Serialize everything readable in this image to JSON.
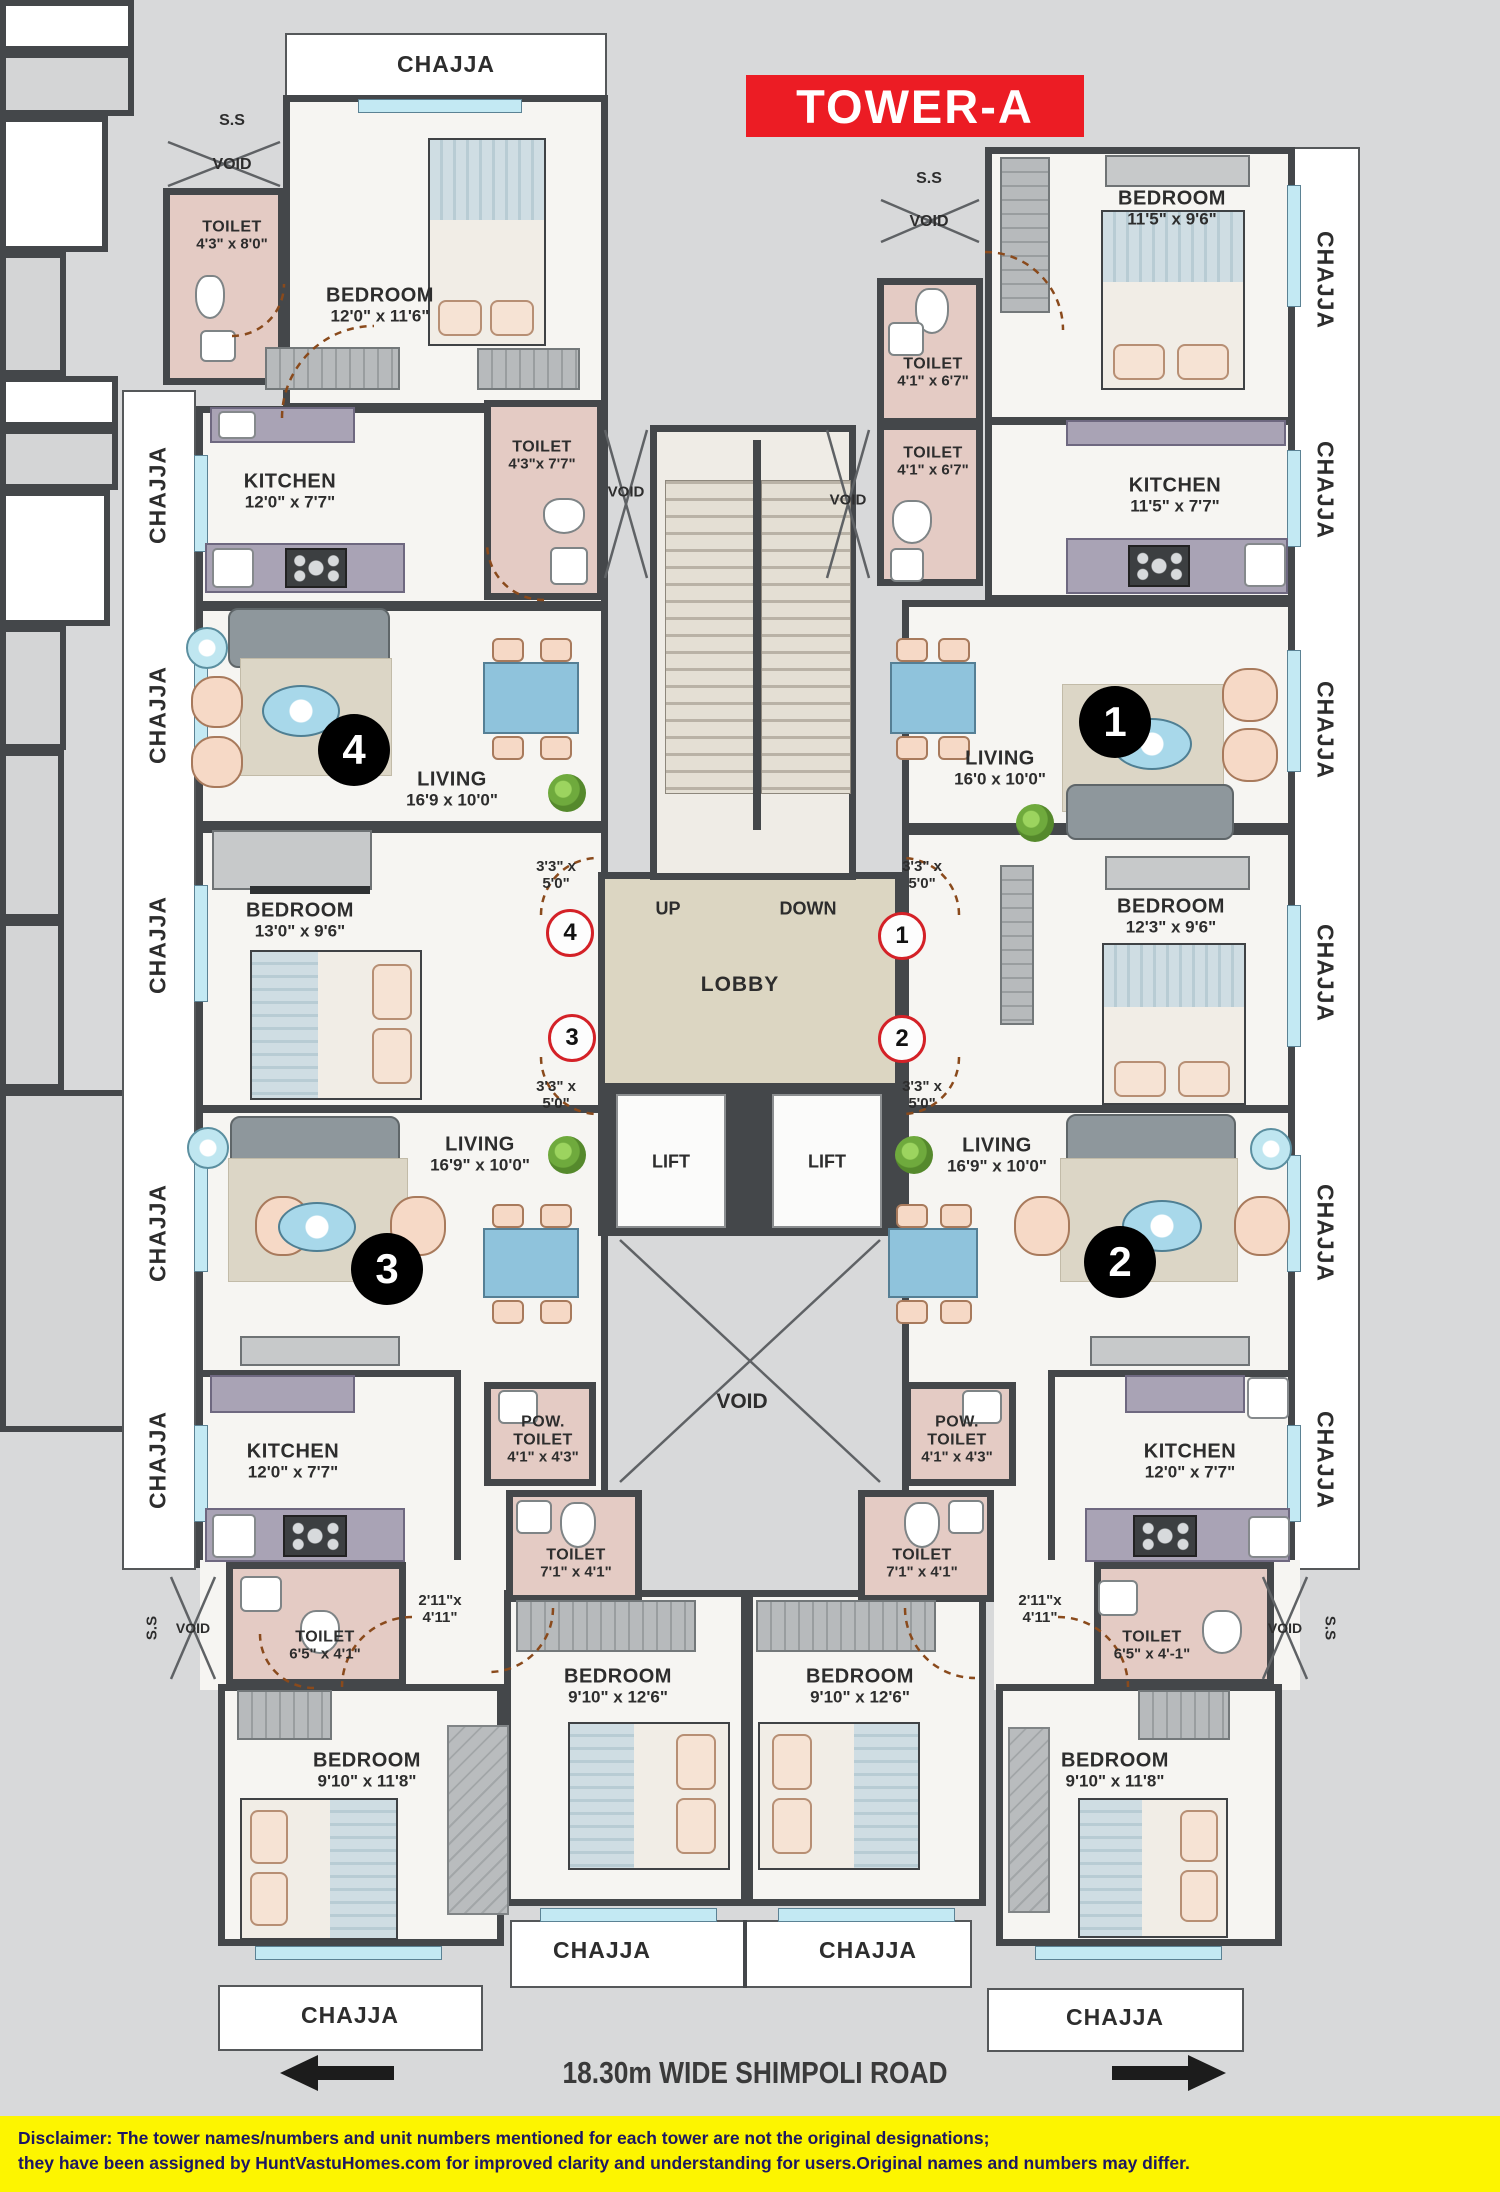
{
  "title": "TOWER-A",
  "chajja": "CHAJJA",
  "core": {
    "ss": "S.S",
    "void": "VOID",
    "up": "UP",
    "down": "DOWN",
    "lobby": "LOBBY",
    "lift": "LIFT"
  },
  "passage_335": {
    "l1": "3'3\" x",
    "l2": "5'0\""
  },
  "passage_211": {
    "l1": "2'11\"x",
    "l2": "4'11\""
  },
  "units": {
    "u1": {
      "no": "1",
      "bedroom_top": {
        "n": "BEDROOM",
        "d": "11'5\" x 9'6\""
      },
      "toilet_a": {
        "n": "TOILET",
        "d": "4'1\" x 6'7\""
      },
      "toilet_b": {
        "n": "TOILET",
        "d": "4'1\" x 6'7\""
      },
      "kitchen": {
        "n": "KITCHEN",
        "d": "11'5\" x 7'7\""
      },
      "living": {
        "n": "LIVING",
        "d": "16'0 x 10'0\""
      },
      "bedroom_side": {
        "n": "BEDROOM",
        "d": "12'3\" x 9'6\""
      }
    },
    "u2": {
      "no": "2",
      "living": {
        "n": "LIVING",
        "d": "16'9\" x 10'0\""
      },
      "kitchen": {
        "n": "KITCHEN",
        "d": "12'0\" x 7'7\""
      },
      "pow": {
        "n1": "POW.",
        "n2": "TOILET",
        "d": "4'1\" x 4'3\""
      },
      "toilet_mid": {
        "n": "TOILET",
        "d": "7'1\" x 4'1\""
      },
      "toilet_small": {
        "n": "TOILET",
        "d": "6'5\" x 4'-1\""
      },
      "bedroom_center": {
        "n": "BEDROOM",
        "d": "9'10\" x 12'6\""
      },
      "bedroom_bottom": {
        "n": "BEDROOM",
        "d": "9'10\" x 11'8\""
      }
    },
    "u3": {
      "no": "3",
      "living": {
        "n": "LIVING",
        "d": "16'9\" x 10'0\""
      },
      "kitchen": {
        "n": "KITCHEN",
        "d": "12'0\" x 7'7\""
      },
      "pow": {
        "n1": "POW.",
        "n2": "TOILET",
        "d": "4'1\" x 4'3\""
      },
      "toilet_mid": {
        "n": "TOILET",
        "d": "7'1\" x 4'1\""
      },
      "toilet_small": {
        "n": "TOILET",
        "d": "6'5\" x 4'1\""
      },
      "bedroom_center": {
        "n": "BEDROOM",
        "d": "9'10\" x 12'6\""
      },
      "bedroom_bottom": {
        "n": "BEDROOM",
        "d": "9'10\" x 11'8\""
      }
    },
    "u4": {
      "no": "4",
      "toilet_top": {
        "n": "TOILET",
        "d": "4'3\" x 8'0\""
      },
      "bedroom_top": {
        "n": "BEDROOM",
        "d": "12'0\" x 11'6\""
      },
      "kitchen": {
        "n": "KITCHEN",
        "d": "12'0\" x 7'7\""
      },
      "toilet_mid": {
        "n": "TOILET",
        "d": "4'3\"x 7'7\""
      },
      "living": {
        "n": "LIVING",
        "d": "16'9 x 10'0\""
      },
      "bedroom_side": {
        "n": "BEDROOM",
        "d": "13'0\" x 9'6\""
      }
    }
  },
  "road": {
    "label": "18.30m WIDE SHIMPOLI ROAD"
  },
  "disclaimer": {
    "bold": "Disclaimer:",
    "line1": " The tower names/numbers and unit numbers mentioned for each tower are not the original designations;",
    "line2": "they have been assigned by HuntVastuHomes.com for improved clarity and understanding for users.Original names and numbers may differ."
  }
}
